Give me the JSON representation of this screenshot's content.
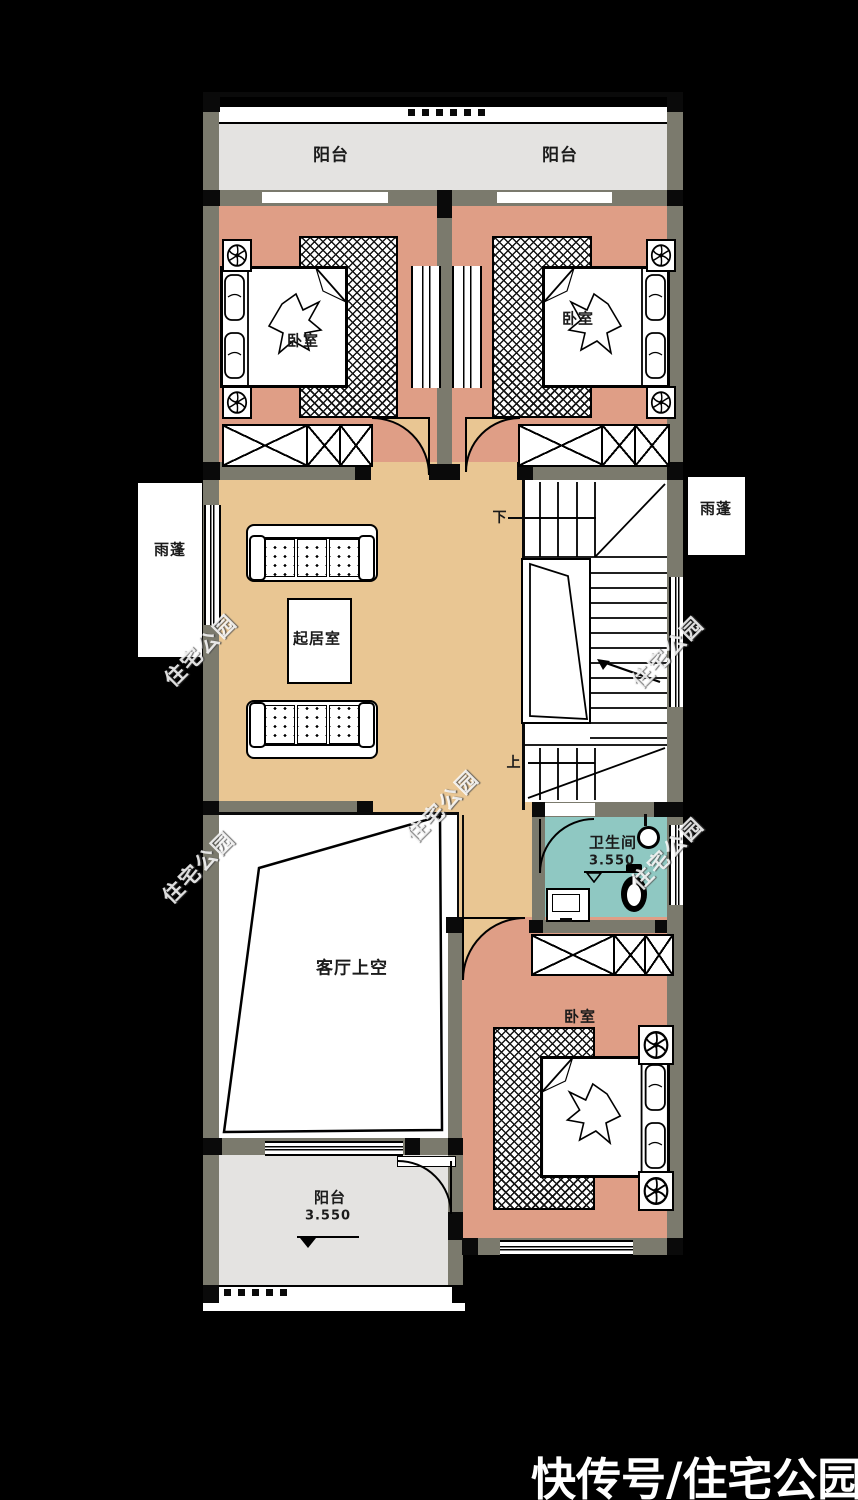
{
  "brand": {
    "text": "快传号/住宅公园"
  },
  "watermark": {
    "text": "住宅公园"
  },
  "colors": {
    "background": "#000000",
    "wall": "#7b7a6d",
    "bedroom_floor": "#df9e86",
    "living_floor": "#e9c693",
    "bathroom_floor": "#8fc8c2",
    "balcony_floor": "#e4e3e1",
    "line": "#0a0a0a"
  },
  "labels": {
    "balcony_top_left": "阳台",
    "balcony_top_right": "阳台",
    "bedroom_top_left": "卧室",
    "bedroom_top_right": "卧室",
    "canopy_left": "雨蓬",
    "canopy_right": "雨蓬",
    "living_room": "起居室",
    "stair_down": "下",
    "stair_up": "上",
    "living_void": "客厅上空",
    "bathroom": "卫生间",
    "bathroom_level": "3.550",
    "bedroom_bottom": "卧室",
    "balcony_bottom": "阳台",
    "balcony_bottom_level": "3.550"
  }
}
